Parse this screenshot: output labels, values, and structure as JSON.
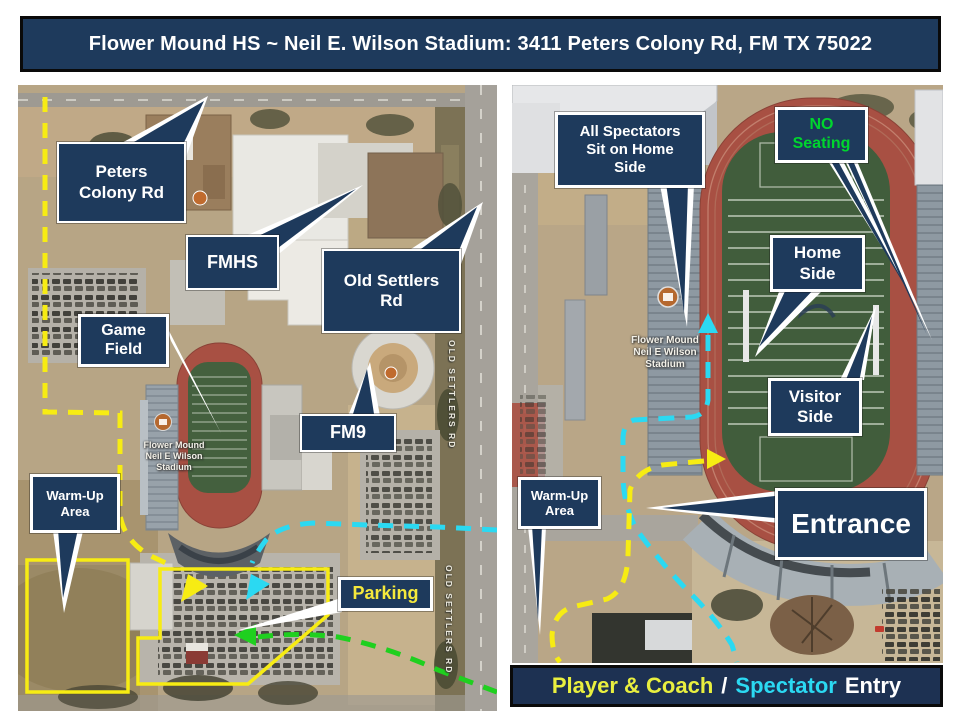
{
  "title_banner": {
    "text": "Flower Mound HS ~ Neil E. Wilson Stadium: 3411 Peters Colony Rd, FM TX 75022"
  },
  "left_map": {
    "callouts": {
      "peters_colony_rd": "Peters\nColony Rd",
      "fmhs": "FMHS",
      "old_settlers_rd": "Old Settlers\nRd",
      "game_field": "Game\nField",
      "fm9": "FM9",
      "warm_up_area": "Warm-Up\nArea",
      "parking": "Parking"
    },
    "map_labels": {
      "stadium": "Flower Mound\nNeil E Wilson\nStadium",
      "old_settlers_rd_top": "OLD SETTLERS RD",
      "old_settlers_rd_bottom": "OLD SETTLERS RD"
    }
  },
  "right_map": {
    "callouts": {
      "all_spectators": "All Spectators\nSit on Home\nSide",
      "no_seating": "NO\nSeating",
      "home_side": "Home\nSide",
      "visitor_side": "Visitor\nSide",
      "warm_up_area": "Warm-Up\nArea",
      "entrance": "Entrance"
    },
    "map_labels": {
      "stadium": "Flower Mound\nNeil E Wilson\nStadium"
    }
  },
  "entry_banner": {
    "player_coach": "Player & Coach",
    "separator": "/",
    "spectator": "Spectator",
    "entry": "Entry"
  },
  "colors": {
    "callout_navy": "#1e3a5c",
    "route_yellow": "#f7ec13",
    "route_cyan": "#2bd9f2",
    "route_green": "#1fd01f",
    "no_seating_green": "#00d62e",
    "parking_label_yellow": "#f5e93c",
    "player_coach_yellow": "#e9ef3f",
    "spectator_cyan": "#2bd9f2"
  }
}
